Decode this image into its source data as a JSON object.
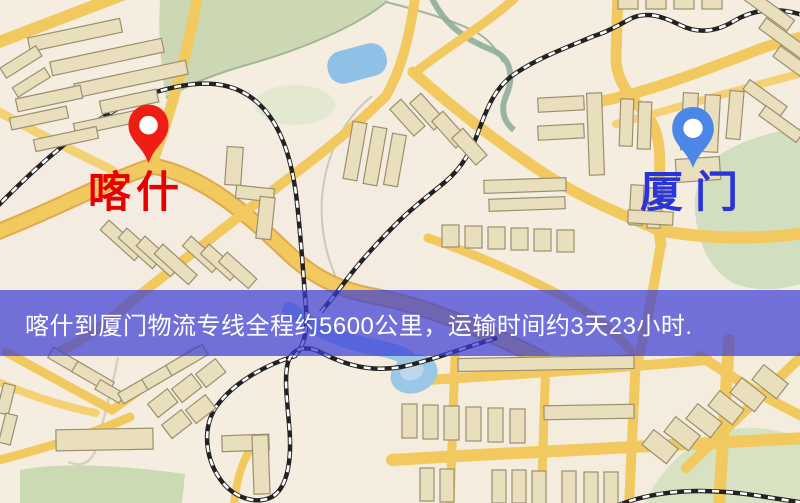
{
  "markers": {
    "kashgar": {
      "label": "喀什",
      "label_color": "#e60000",
      "pin_color": "#ee1d15"
    },
    "xiamen": {
      "label": "厦门",
      "label_color": "#2a35d8",
      "pin_color": "#4c86e9"
    }
  },
  "banner": {
    "text": "喀什到厦门物流专线全程约5600公里，运输时间约3天23小时.",
    "background": "#3c3cd6",
    "opacity": "0.70",
    "text_color": "#ffffff"
  },
  "map": {
    "colors": {
      "background": "#f5eee0",
      "road": "#f2c95f",
      "road_light": "#f4d175",
      "road_casing": "#dfa94e",
      "park": "#ccd8b4",
      "water": "#8fc0e5",
      "building": "#eadfbd",
      "building_outline": "#9a8f6f",
      "railway": "#222222"
    }
  }
}
